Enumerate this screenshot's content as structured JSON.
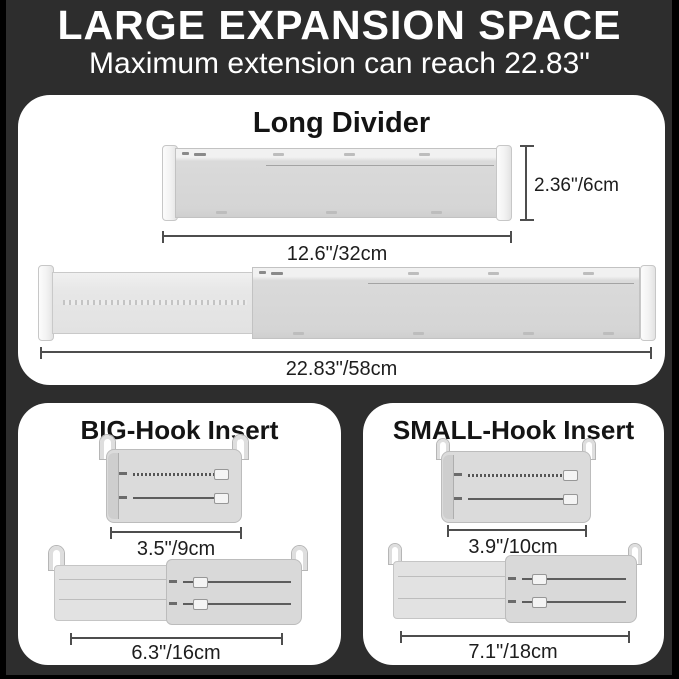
{
  "header": {
    "title": "LARGE EXPANSION SPACE",
    "subtitle": "Maximum extension can reach 22.83\""
  },
  "panels": {
    "long_divider": {
      "title": "Long Divider",
      "height": "2.36\"/6cm",
      "collapsed_length": "12.6\"/32cm",
      "extended_length": "22.83\"/58cm"
    },
    "big_hook_insert": {
      "title": "BIG-Hook Insert",
      "collapsed_length": "3.5\"/9cm",
      "extended_length": "6.3\"/16cm"
    },
    "small_hook_insert": {
      "title": "SMALL-Hook Insert",
      "collapsed_length": "3.9\"/10cm",
      "extended_length": "7.1\"/18cm"
    }
  },
  "colors": {
    "background": "#2d2d2d",
    "edge_frame": "#000000",
    "panel_background": "#ffffff",
    "header_text": "#ffffff",
    "heading_text": "#141414",
    "divider_gray": "#d5d5d5",
    "measure_line": "#4e4e4e"
  }
}
